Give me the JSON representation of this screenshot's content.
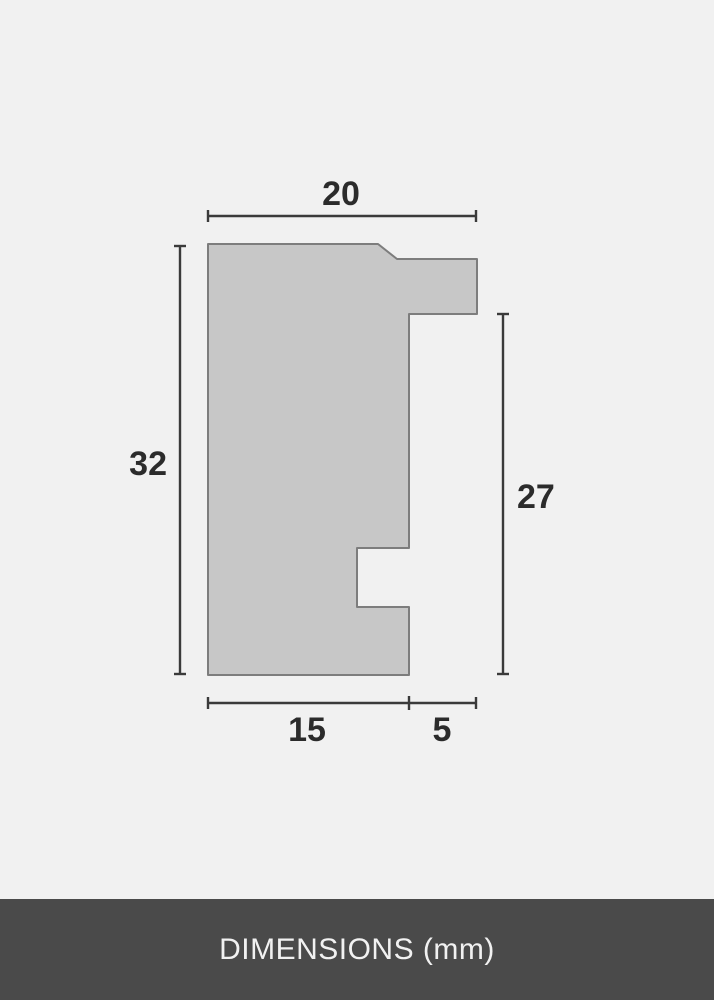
{
  "diagram": {
    "dimensions": {
      "top_width": "20",
      "left_height": "32",
      "right_height": "27",
      "bottom_body_width": "15",
      "bottom_rabbet_width": "5"
    },
    "colors": {
      "background": "#f1f1f1",
      "profile_fill": "#c7c7c7",
      "profile_stroke": "#7d7d7d",
      "dimension_line": "#3a3a3a",
      "label_text": "#2b2b2b",
      "footer_background": "#4a4a4a",
      "footer_text": "#f1f1f1"
    }
  },
  "footer": {
    "label": "DIMENSIONS (mm)"
  }
}
